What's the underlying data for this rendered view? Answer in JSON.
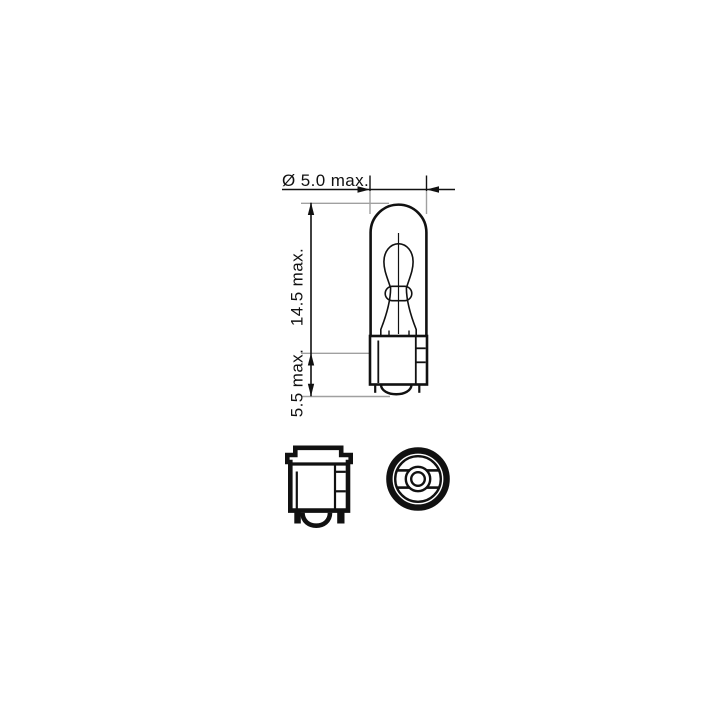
{
  "colors": {
    "line": "#111111",
    "extension": "#a0a0a0",
    "text": "#111111",
    "background": "#ffffff"
  },
  "drawing": {
    "dimensions": {
      "diameter": "Ø 5.0 max.",
      "overall_length": "14.5 max.",
      "base_length": "5.5 max."
    },
    "views": {
      "main": "bulb-side-elevation",
      "bottom_left": "wedge-base-side-view",
      "bottom_right": "wedge-base-top-view"
    }
  }
}
